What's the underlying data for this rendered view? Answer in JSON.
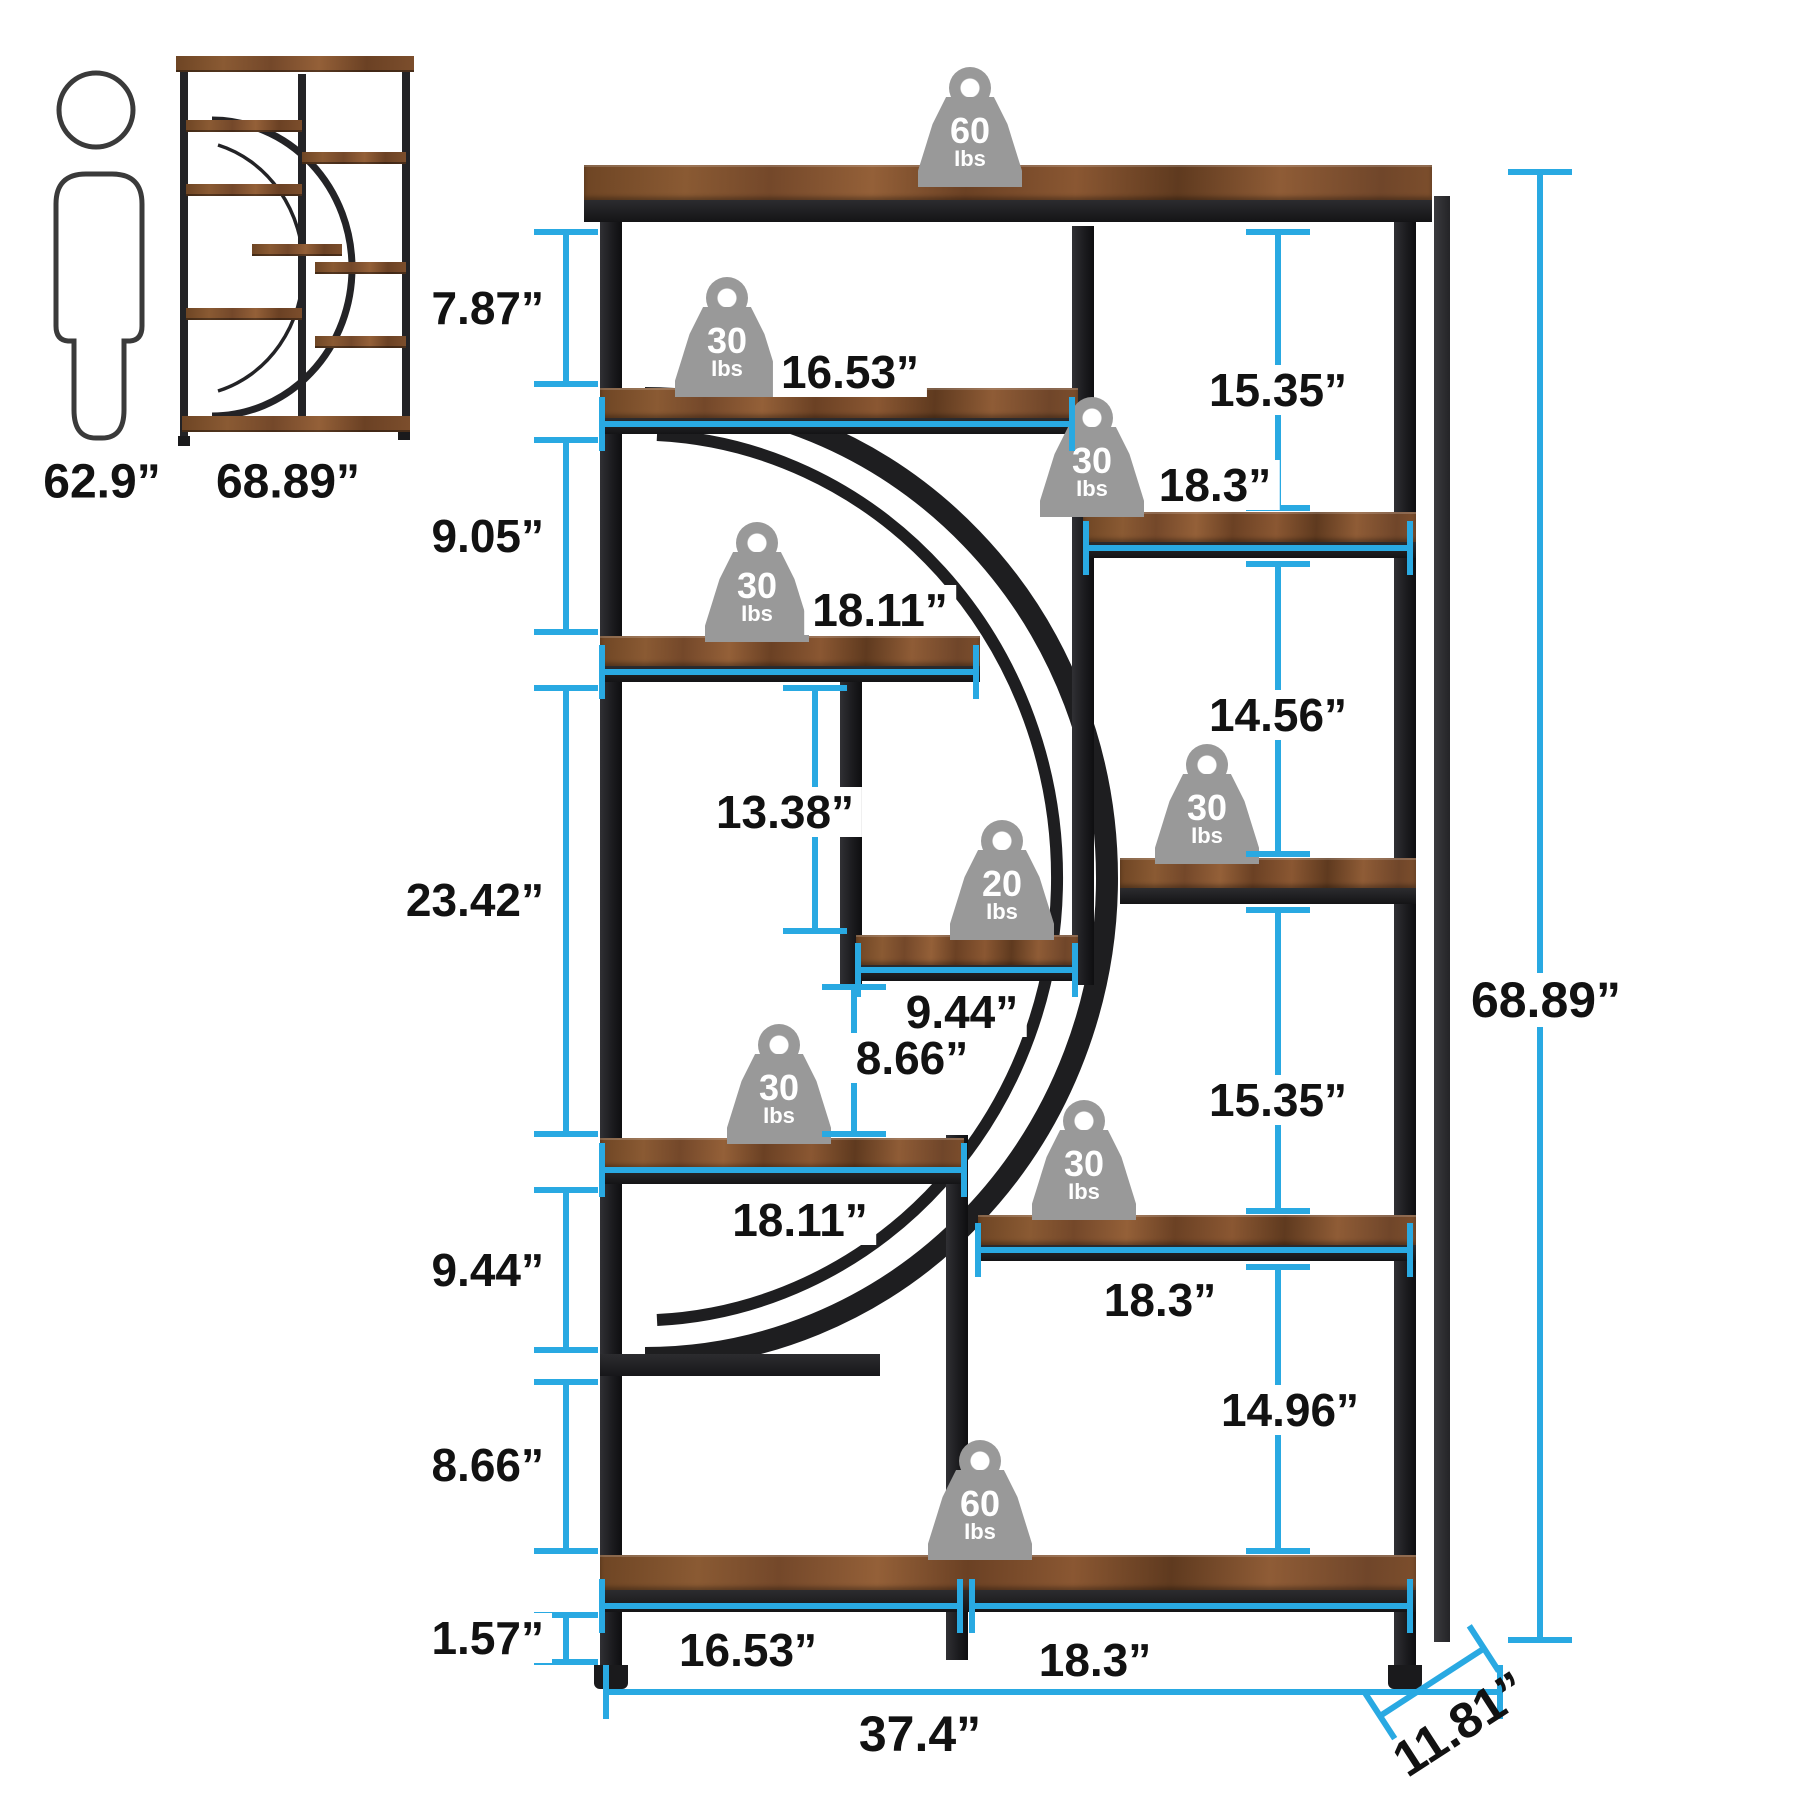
{
  "reference": {
    "person_height_label": "62.9”",
    "shelf_height_label": "68.89”"
  },
  "weights": [
    {
      "value": "60",
      "unit": "Ibs",
      "location": "top-shelf"
    },
    {
      "value": "30",
      "unit": "Ibs",
      "location": "upper-left-shelf"
    },
    {
      "value": "30",
      "unit": "Ibs",
      "location": "upper-right-shelf"
    },
    {
      "value": "30",
      "unit": "Ibs",
      "location": "mid-left-shelf"
    },
    {
      "value": "20",
      "unit": "Ibs",
      "location": "center-small-shelf"
    },
    {
      "value": "30",
      "unit": "Ibs",
      "location": "mid-right-shelf"
    },
    {
      "value": "30",
      "unit": "Ibs",
      "location": "lower-left-shelf"
    },
    {
      "value": "30",
      "unit": "Ibs",
      "location": "lower-right-shelf"
    },
    {
      "value": "60",
      "unit": "Ibs",
      "location": "bottom-shelf"
    }
  ],
  "vertical_dims": {
    "left": [
      {
        "name": "top-compartment-height",
        "label": "7.87”"
      },
      {
        "name": "second-compartment-height",
        "label": "9.05”"
      },
      {
        "name": "tall-compartment-height",
        "label": "23.42”"
      },
      {
        "name": "lower-compartment-height",
        "label": "9.44”"
      },
      {
        "name": "bottom-compartment-height",
        "label": "8.66”"
      },
      {
        "name": "leg-height",
        "label": "1.57”"
      }
    ],
    "middle": [
      {
        "name": "center-niche-height",
        "label": "13.38”"
      },
      {
        "name": "under-small-shelf-height",
        "label": "8.66”"
      }
    ],
    "right": [
      {
        "name": "upper-right-compartment",
        "label": "15.35”"
      },
      {
        "name": "mid-right-compartment",
        "label": "14.56”"
      },
      {
        "name": "lower-right-compartment",
        "label": "15.35”"
      },
      {
        "name": "bottom-right-compartment",
        "label": "14.96”"
      }
    ],
    "overall_height": "68.89”"
  },
  "horizontal_dims": {
    "shelves": [
      {
        "name": "top-left-shelf-width",
        "label": "16.53”"
      },
      {
        "name": "upper-right-shelf-width",
        "label": "18.3”"
      },
      {
        "name": "upper-left-shelf-width",
        "label": "18.11”"
      },
      {
        "name": "center-small-shelf-width",
        "label": "9.44”"
      },
      {
        "name": "lower-left-shelf-width",
        "label": "18.11”"
      },
      {
        "name": "lower-right-shelf-width",
        "label": "18.3”"
      },
      {
        "name": "bottom-left-section-width",
        "label": "16.53”"
      },
      {
        "name": "bottom-right-section-width",
        "label": "18.3”"
      }
    ],
    "overall_width": "37.4”",
    "depth": "11.81”"
  },
  "colors": {
    "dimension_line": "#29a9e2",
    "frame": "#232326",
    "wood": "#7c4e2c",
    "weight_badge": "#999999"
  }
}
